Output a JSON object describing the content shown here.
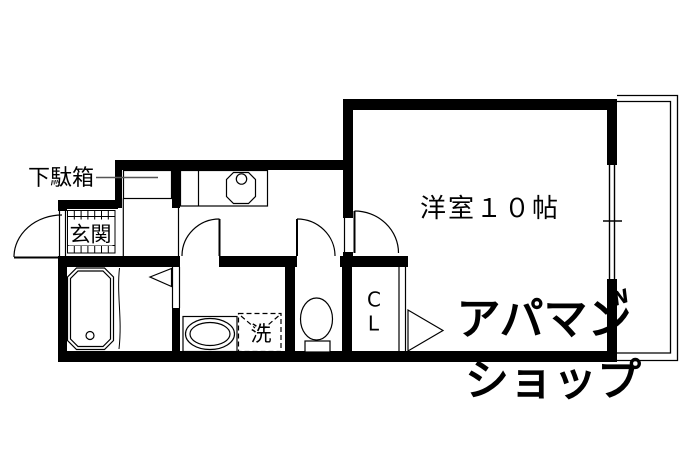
{
  "plan": {
    "labels": {
      "shoe_cabinet": "下駄箱",
      "entrance": "玄関",
      "main_room": "洋室１０帖",
      "washer": "洗",
      "closet_line1": "C",
      "closet_line2": "L"
    },
    "watermark": {
      "line1": "アパマン",
      "line2": "ショップ",
      "mark": "N",
      "color": "#d8d8d8"
    },
    "colors": {
      "wall": "#000000",
      "background": "#ffffff",
      "line": "#000000",
      "leader": "#555555"
    }
  }
}
